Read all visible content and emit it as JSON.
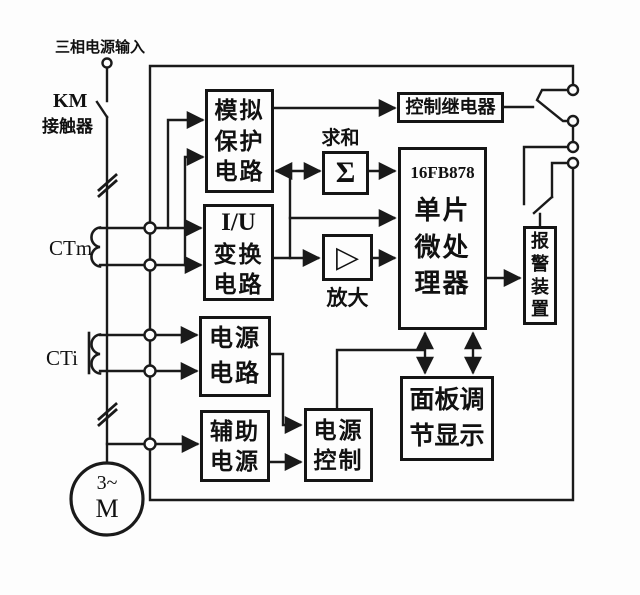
{
  "diagram": {
    "title": "三相电源输入",
    "labels": {
      "km": "KM",
      "contactor": "接触器",
      "ctm": "CTm",
      "cti": "CTi",
      "motor_top": "3~",
      "motor_bottom": "M",
      "sum": "求和",
      "sigma": "Σ",
      "amplify": "放大",
      "amp_symbol": "▷"
    },
    "blocks": {
      "analog_protection": {
        "lines": [
          "模拟",
          "保护",
          "电路"
        ]
      },
      "iu_conversion": {
        "lines": [
          "I/U",
          "变换",
          "电路"
        ]
      },
      "power_circuit": {
        "lines": [
          "电源",
          "电路"
        ]
      },
      "aux_power": {
        "lines": [
          "辅助",
          "电源"
        ]
      },
      "control_relay": {
        "label": "控制继电器"
      },
      "mcu": {
        "chip": "16FB878",
        "lines": [
          "单片",
          "微处",
          "理器"
        ]
      },
      "alarm": {
        "chars": [
          "报",
          "警",
          "装",
          "置"
        ]
      },
      "panel_display": {
        "lines": [
          "面板调",
          "节显示"
        ]
      },
      "power_control": {
        "lines": [
          "电源",
          "控制"
        ]
      }
    },
    "colors": {
      "wire": "#1a1a1a",
      "background": "#ffffff",
      "box_border": "#151515"
    }
  }
}
